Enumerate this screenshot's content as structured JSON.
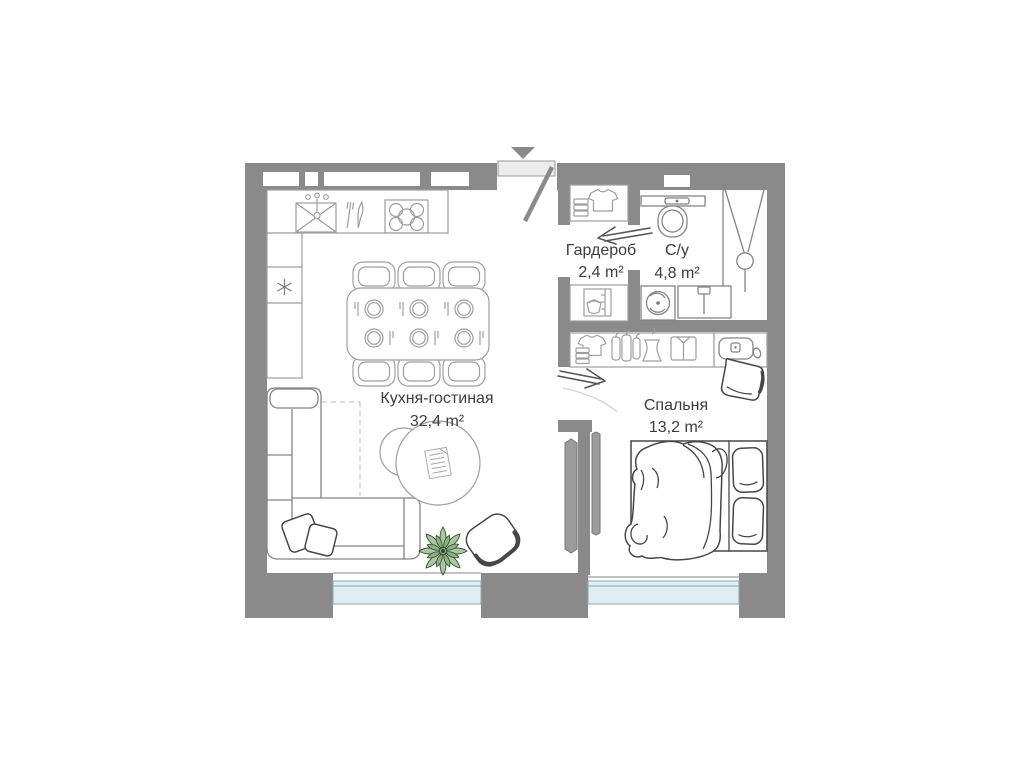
{
  "plan": {
    "rooms": [
      {
        "name": "Кухня-гостиная",
        "area": "32,4 m²"
      },
      {
        "name": "Гардероб",
        "area": "2,4 m²"
      },
      {
        "name": "С/у",
        "area": "4,8 m²"
      },
      {
        "name": "Спальня",
        "area": "13,2 m²"
      }
    ],
    "colors": {
      "wall": "#8a8a8a",
      "window_glass": "#dfedf4",
      "window_frame": "#8fa6b0",
      "door_leaf": "#ececec",
      "plant_green": "#a9c7a1",
      "furniture_line_light": "#9e9e9e",
      "furniture_line_dark": "#474747",
      "label_text": "#3d3d3d"
    },
    "icons": [
      "entry-arrow-icon",
      "entrance-door",
      "sliding-door-arrow-icon",
      "kitchen-sink-icon",
      "cutlery-icon",
      "stove-icon",
      "fridge-icon",
      "dining-table",
      "dining-chair",
      "plate-icon",
      "sofa",
      "cushion",
      "coffee-table",
      "magazine-icon",
      "plant-icon",
      "armchair",
      "tv-icon",
      "rug-outline",
      "tshirt-icon",
      "folded-stack-icon",
      "laundry-cabinet-icon",
      "toilet-icon",
      "shower-icon",
      "washing-machine-icon",
      "bathroom-sink-icon",
      "hangers-icon",
      "dress-icon",
      "folded-shirt-icon",
      "nightstand",
      "vase-icon",
      "bedroom-chair",
      "bed",
      "pillow"
    ]
  }
}
